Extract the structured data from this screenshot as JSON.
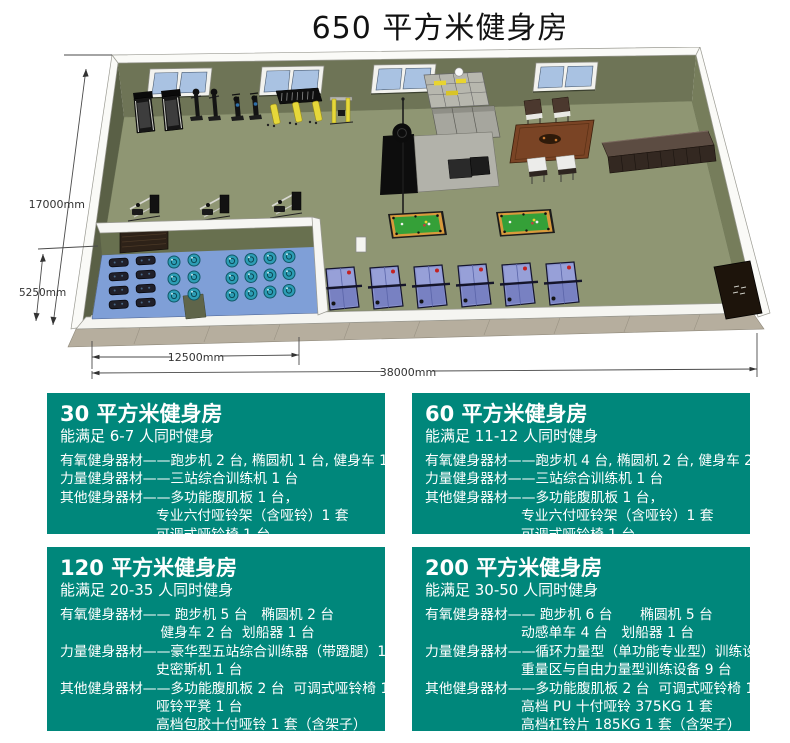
{
  "title": "650 平方米健身房",
  "plan": {
    "dim_height_label": "17000mm",
    "dim_studio_depth_label": "5250mm",
    "dim_studio_width_label": "12500mm",
    "dim_width_label": "38000mm",
    "colors": {
      "floor": "#8f9673",
      "wall_face": "#6e7456",
      "studio_floor": "#7f9fd7",
      "window_pane": "#a9c2e2",
      "pool_felt": "#35a038",
      "pingpong_top": "#8a93cf",
      "equipment_yellow": "#e6d83a",
      "card_background": "#00877b"
    }
  },
  "cards": [
    {
      "title": "30 平方米健身房",
      "subtitle": "能满足 6-7 人同时健身",
      "lines": [
        "有氧健身器材——跑步机 2 台, 椭圆机 1 台, 健身车 1 台",
        "力量健身器材——三站综合训练机 1 台",
        "其他健身器材——多功能腹肌板 1 台，",
        "专业六付哑铃架（含哑铃）1 套",
        "可调式哑铃椅 1 台"
      ]
    },
    {
      "title": "60 平方米健身房",
      "subtitle": "能满足 11-12 人同时健身",
      "lines": [
        "有氧健身器材——跑步机 4 台, 椭圆机 2 台, 健身车 2 台",
        "力量健身器材——三站综合训练机 1 台",
        "其他健身器材——多功能腹肌板 1 台，",
        "专业六付哑铃架（含哑铃）1 套",
        "可调式哑铃椅 1 台"
      ]
    },
    {
      "title": "120 平方米健身房",
      "subtitle": "能满足 20-35 人同时健身",
      "lines": [
        "有氧健身器材—— 跑步机 5 台　椭圆机 2 台",
        " 健身车 2 台  划船器 1 台",
        "力量健身器材——豪华型五站综合训练器（带蹬腿）1 台",
        "史密斯机 1 台",
        "其他健身器材——多功能腹肌板 2 台  可调式哑铃椅 1 台",
        "哑铃平凳 1 台",
        "高档包胶十付哑铃 1 套（含架子）"
      ]
    },
    {
      "title": "200 平方米健身房",
      "subtitle": "能满足 30-50 人同时健身",
      "lines": [
        "有氧健身器材—— 跑步机 6 台　　椭圆机 5 台",
        "动感单车 4 台　划船器 1 台",
        "力量健身器材——循环力量型（单功能专业型）训练设备 7 台",
        "重量区与自由力量型训练设备 9 台",
        "其他健身器材——多功能腹肌板 2 台  可调式哑铃椅 1 台",
        "高档 PU 十付哑铃 375KG 1 套",
        "高档杠铃片 185KG 1 套（含架子）"
      ]
    }
  ]
}
